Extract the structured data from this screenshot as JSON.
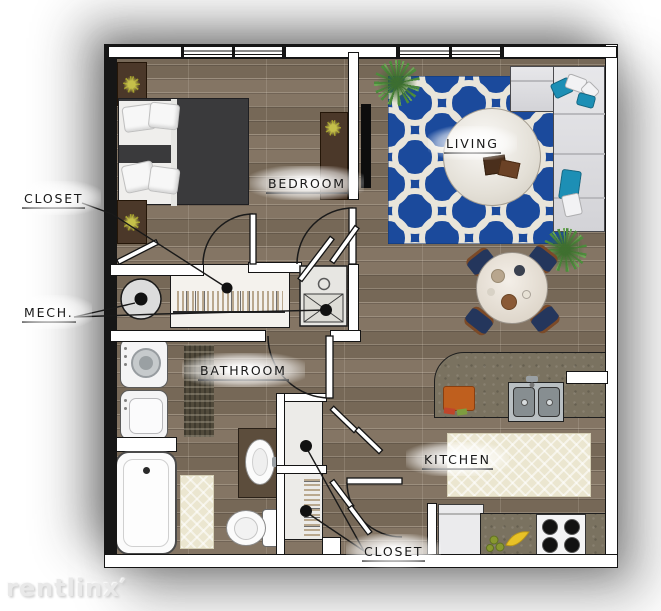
{
  "plan_title": "studio-apartment-floor-plan",
  "labels": {
    "closet_top": "CLOSET",
    "bedroom": "BEDROOM",
    "living": "LIVING",
    "mech": "MECH.",
    "bathroom": "BATHROOM",
    "kitchen": "KITCHEN",
    "closet_bottom": "CLOSET"
  },
  "watermark": {
    "text": "rentlinx′"
  },
  "colors": {
    "wall": "#161616",
    "floor_wood": "#7d6e5c",
    "rug_blue": "#1b4a9c",
    "rug_pattern_white": "#e9e5da",
    "rug_cream": "#ebe6d0",
    "counter_granite": "#7a7260",
    "sofa_gray": "#dcdcdf",
    "pillow_teal": "#1d8fb5",
    "bed_duvet": "#3a3a3c",
    "wood_furniture": "#4b3829",
    "chair_navy": "#24365c",
    "chair_arm_brown": "#7b4a28",
    "plant_green": "#4d8c3c",
    "plant_yellow": "#9e9a28",
    "cutting_board_orange": "#bf5f1e",
    "banana_yellow": "#e8c227",
    "appliance_white": "#f4f4f5",
    "stainless": "#b9bfc2"
  },
  "furniture": [
    "bed",
    "pillows",
    "nightstand",
    "dresser",
    "tv",
    "sectional-sofa",
    "throw-pillows",
    "coffee-table",
    "books",
    "area-rug",
    "floor-plants",
    "dining-table",
    "dining-chairs",
    "tableware",
    "water-heater",
    "mechanical-unit",
    "hanging-closet",
    "washer",
    "dryer",
    "bath-runner-rug",
    "bathtub",
    "tub-shelf",
    "bath-mat",
    "vanity-sink",
    "toilet",
    "storage-closets",
    "kitchen-counter",
    "double-basin-sink",
    "faucet",
    "cutting-board",
    "vegetables",
    "pass-through-window",
    "kitchen-rug",
    "refrigerator",
    "bananas",
    "limes",
    "stove-cooktop",
    "door-swings",
    "bifold-doors",
    "windows"
  ]
}
